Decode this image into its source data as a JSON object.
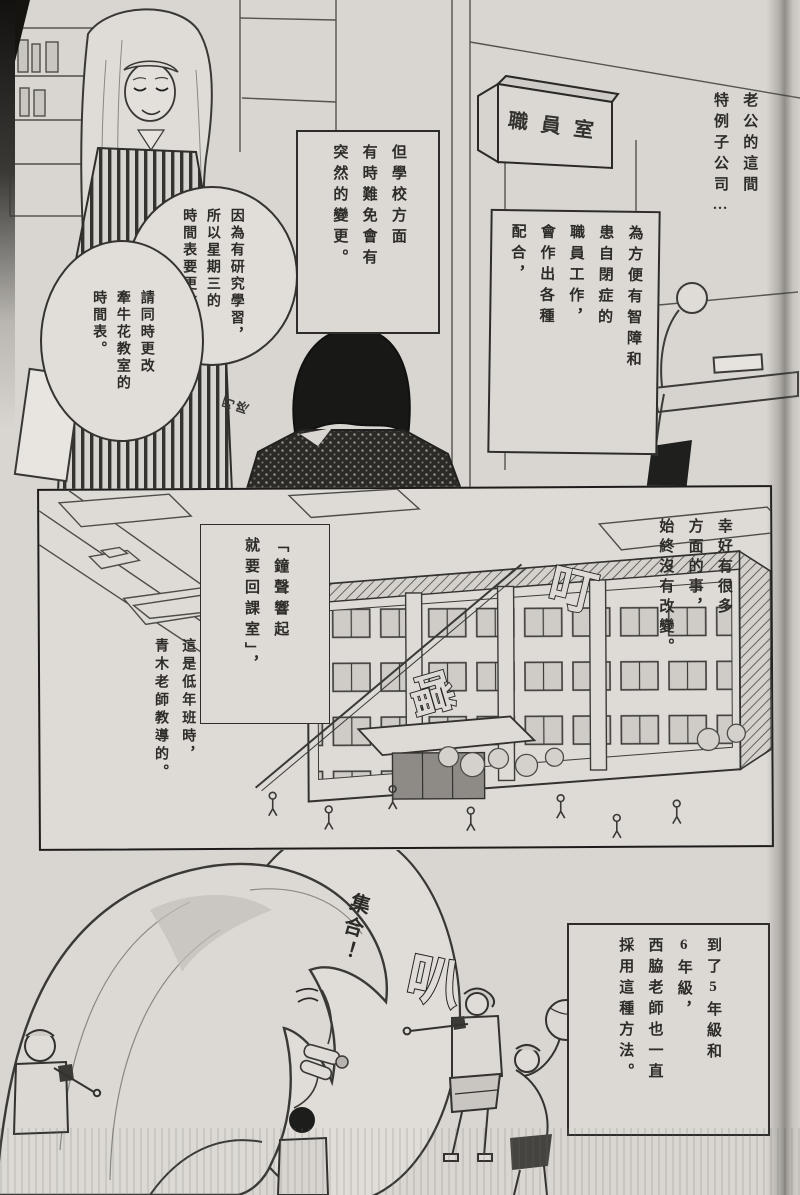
{
  "colors": {
    "paper": "#d9d6d1",
    "panel_bg": "#dedbd6",
    "ink": "#2a2a2a",
    "bubble_bg": "#e1ded9"
  },
  "panel_top": {
    "caption_company": "老公的這間\n特例子公司…",
    "caption_accommodation": "為方便有智障和\n患自閉症的\n職員工作，\n會作出各種\n配合，",
    "caption_changes": "但學校方面\n有時難免會有\n突然的變更。",
    "bubble_schedule": "因為有研究學習，\n所以星期三的\n時間表要更改。",
    "bubble_classroom": "請同時更改\n牽牛花教室的\n時間表。",
    "sign_staff_room": "職員室",
    "sfx_small": "叮咚"
  },
  "panel_middle": {
    "caption_unchanged": "幸好有很多\n方面的事，\n始終沒有改變。",
    "caption_bell_rule": "「鐘聲響起\n就要回課室」，",
    "caption_teacher": "這是低年班時，\n青木老師教導的。",
    "sfx_ding": "叮",
    "sfx_dong": "噹"
  },
  "panel_bottom": {
    "bubble_assemble": "集合！",
    "sfx_whistle": "叭",
    "caption_method": "到了5年級和\n6年級，\n西脇老師也一直\n採用這種方法。"
  }
}
